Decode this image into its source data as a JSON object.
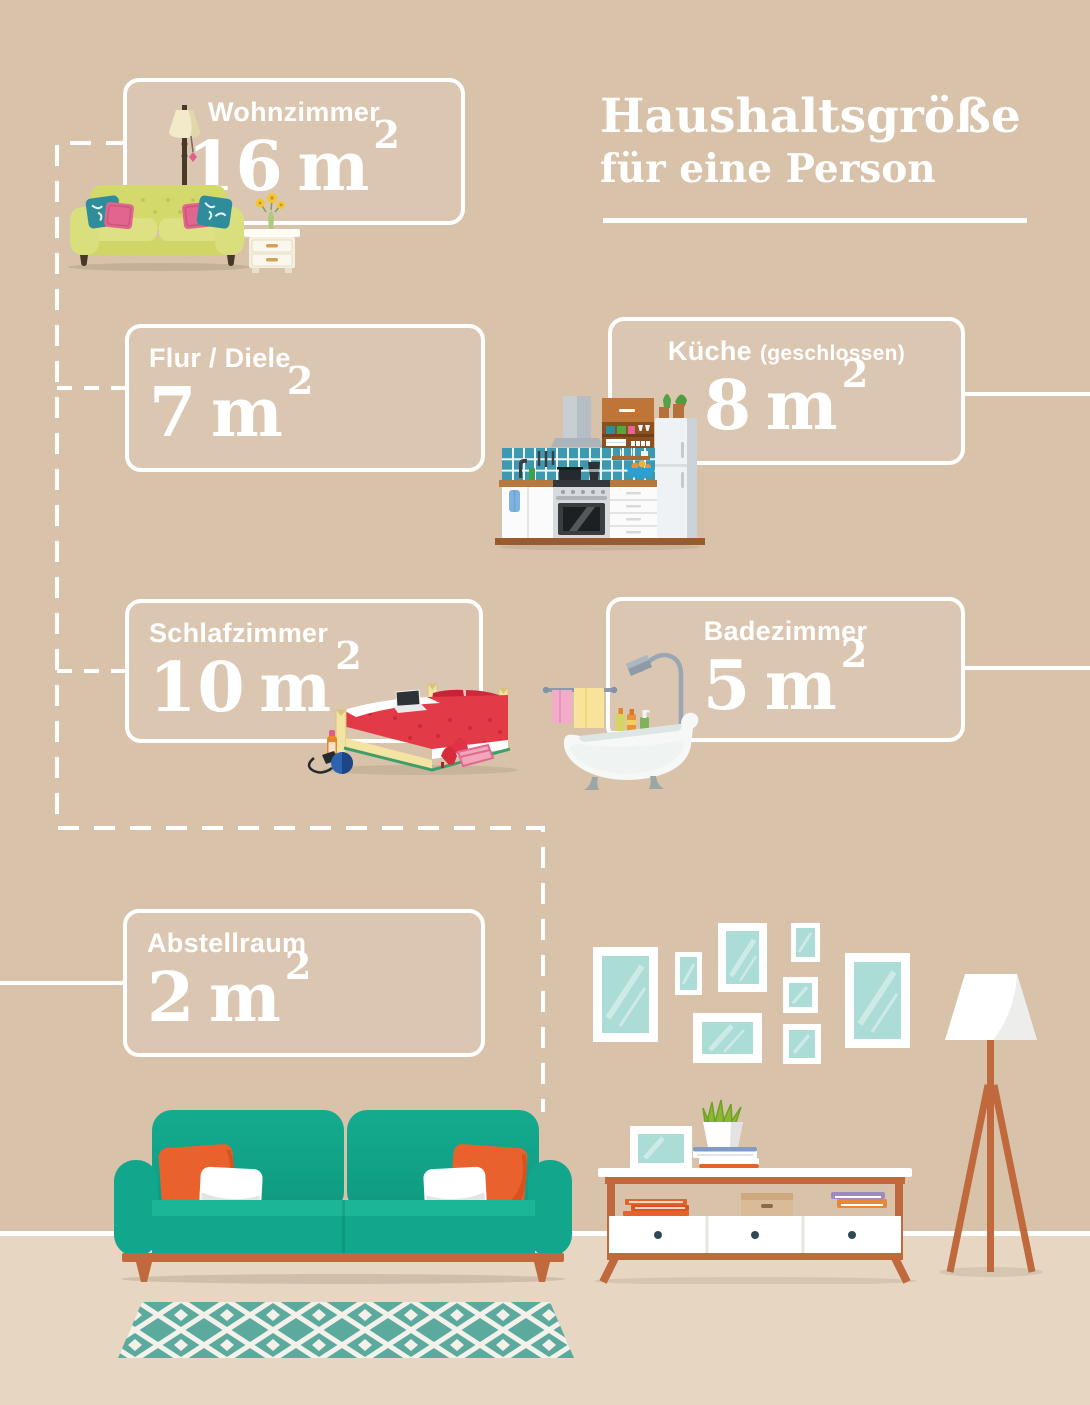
{
  "header": {
    "title_line1": "Haushaltsgröße",
    "title_line2": "für eine Person"
  },
  "rooms": [
    {
      "name": "Wohnzimmer",
      "area_value": "16",
      "area_unit": "m",
      "area_exponent": "2"
    },
    {
      "name": "Flur / Diele",
      "area_value": "7",
      "area_unit": "m",
      "area_exponent": "2"
    },
    {
      "name": "Küche",
      "name_suffix": "(geschlossen)",
      "area_value": "8",
      "area_unit": "m",
      "area_exponent": "2"
    },
    {
      "name": "Schlafzimmer",
      "area_value": "10",
      "area_unit": "m",
      "area_exponent": "2"
    },
    {
      "name": "Badezimmer",
      "area_value": "5",
      "area_unit": "m",
      "area_exponent": "2"
    },
    {
      "name": "Abstellraum",
      "area_value": "2",
      "area_unit": "m",
      "area_exponent": "2"
    }
  ],
  "colors": {
    "wall": "#d8c2aa",
    "floor": "#e7d6c2",
    "line_white": "#ffffff",
    "sofa_teal": "#12a78c",
    "wood_orange": "#c0693c",
    "pillow_orange": "#e9622d",
    "old_sofa_green": "#d3d96b",
    "bed_red": "#e23b47",
    "tile_teal": "#3d99af",
    "glass_mint": "#abdcd6"
  },
  "illustrations": {
    "top_left": "olive-sofa-floor-lamp-side-table",
    "kitchen": "kitchen-unit-stove-fridge",
    "bedroom": "double-bed-laptop-hairdryer-shoes",
    "bathroom": "clawfoot-tub-shower-towels",
    "gallery": "picture-frame-gallery-wall",
    "bottom_sofa": "teal-sofa-with-pillows",
    "sideboard": "white-sideboard-books-plant",
    "floor_lamp": "tripod-floor-lamp",
    "rug": "diamond-pattern-rug"
  }
}
